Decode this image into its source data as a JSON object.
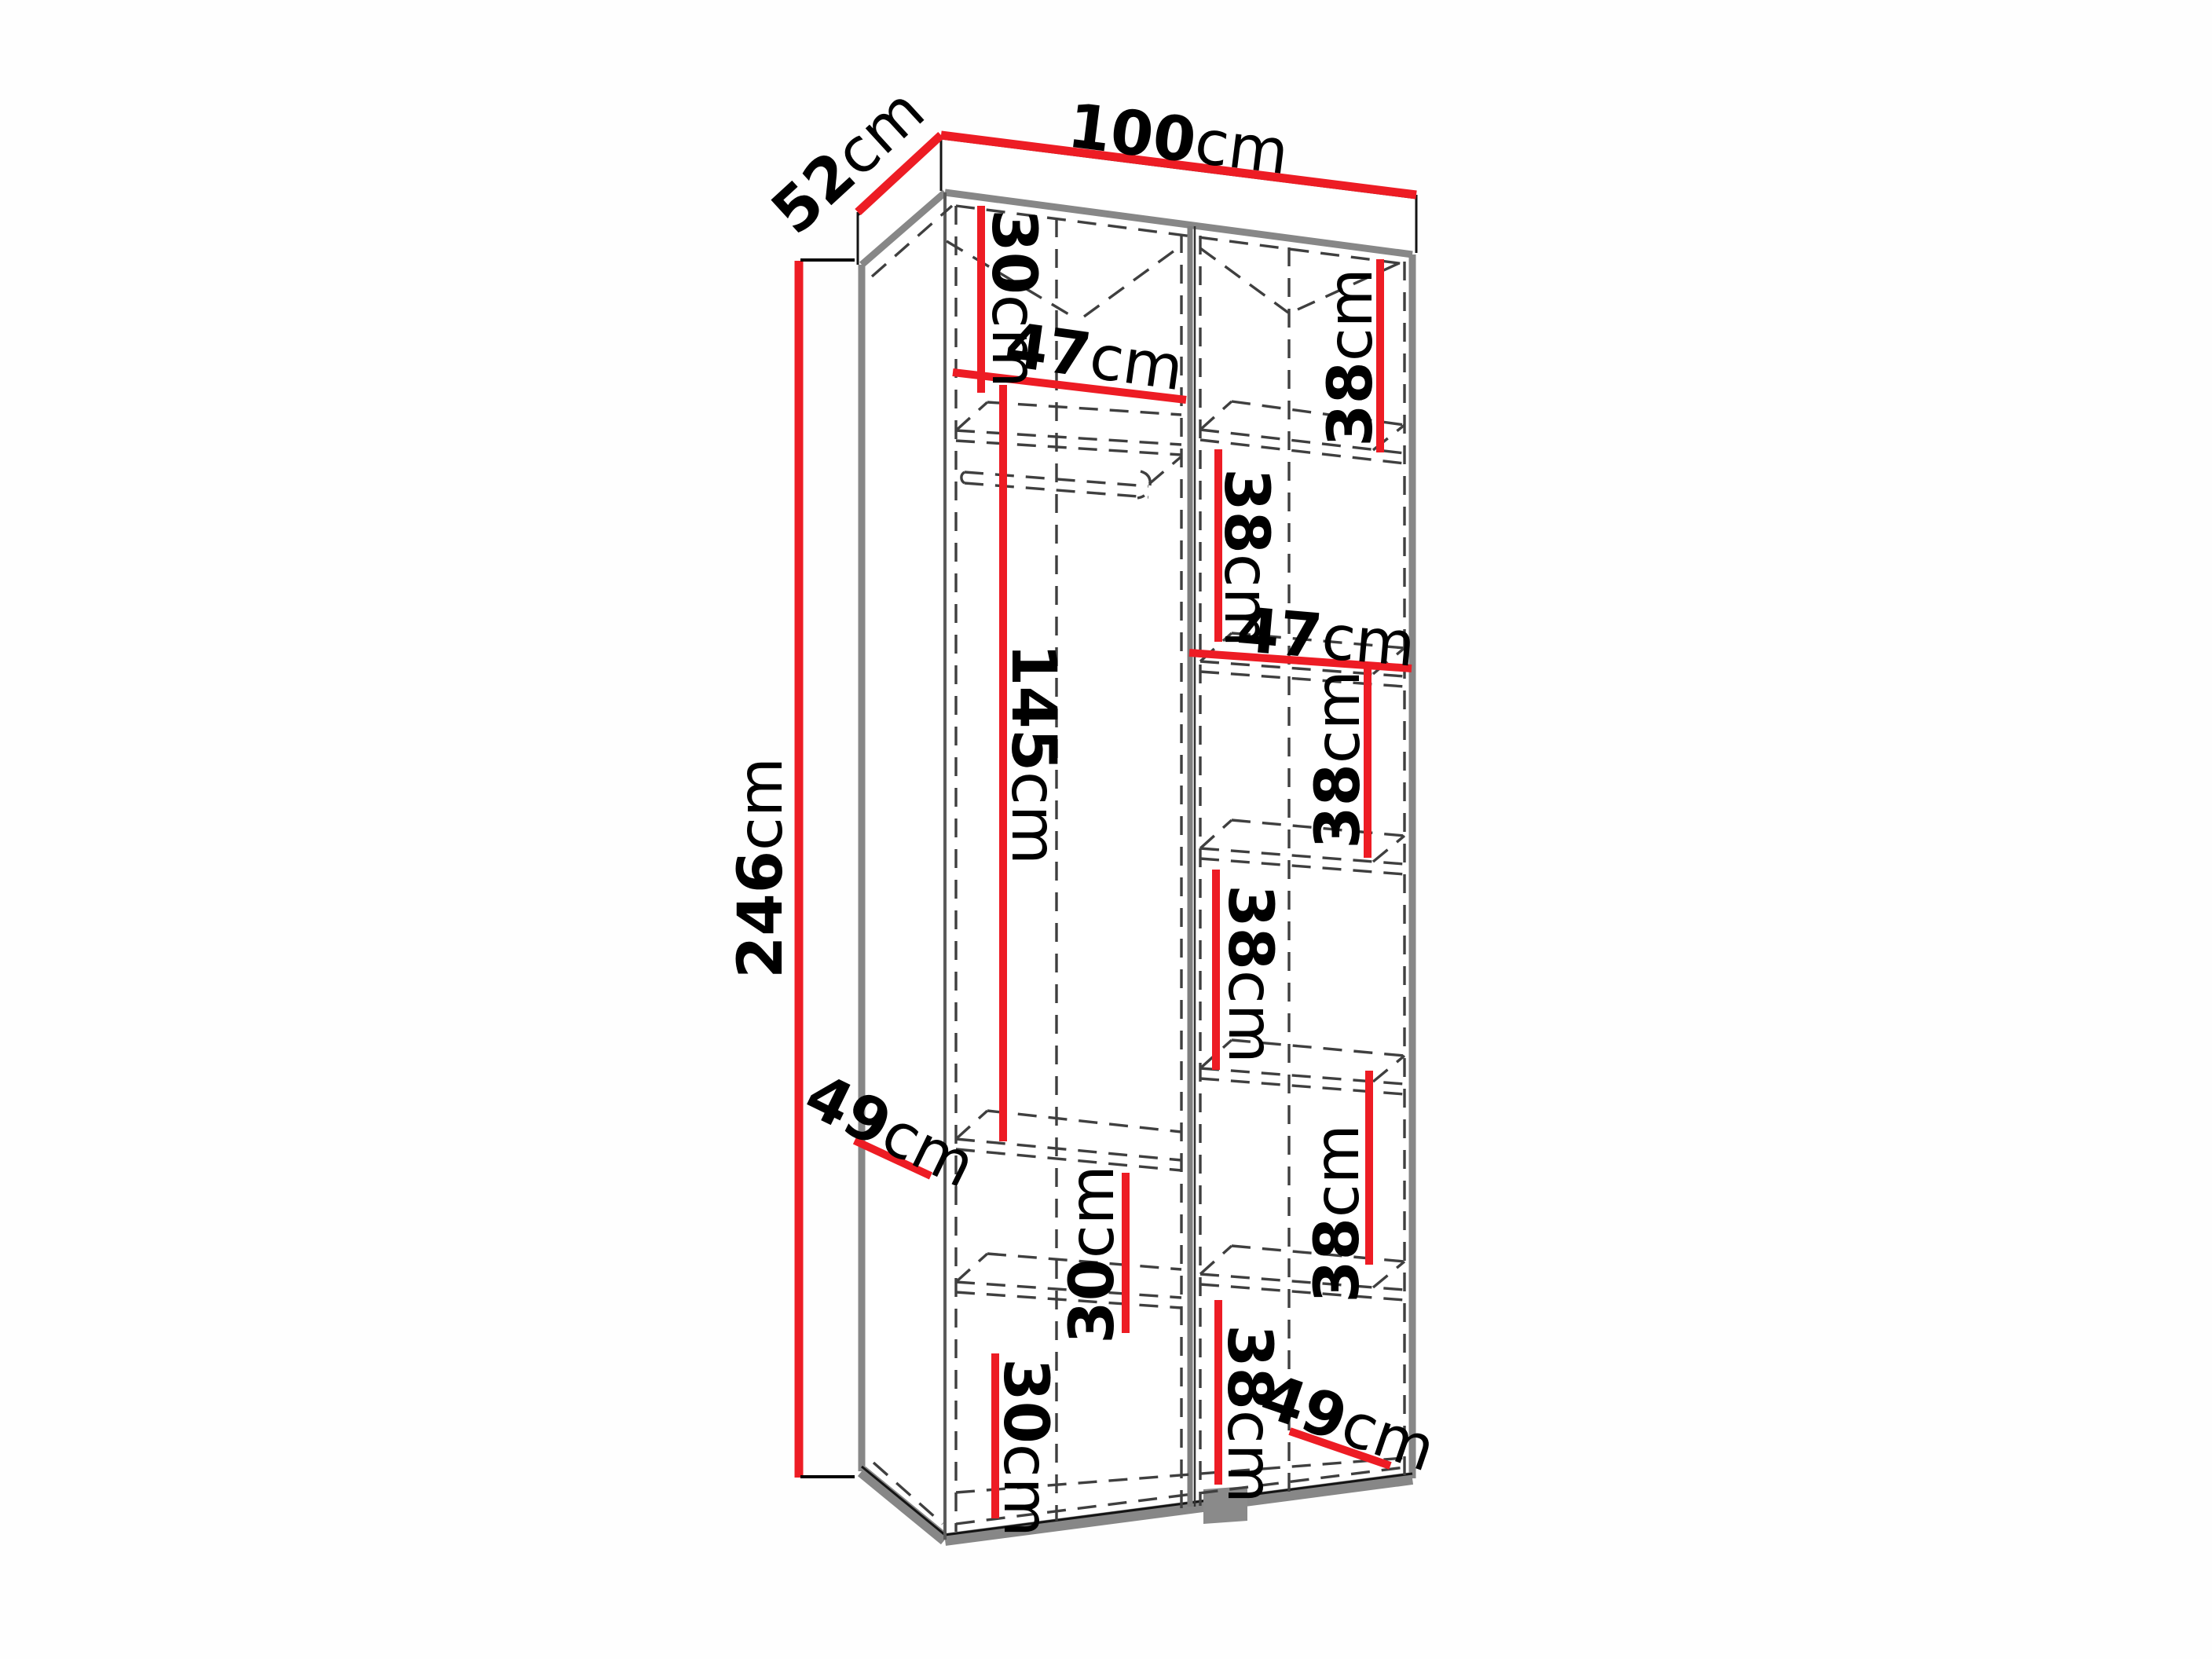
{
  "diagram": {
    "type": "wardrobe-dimension-diagram",
    "unit": "cm",
    "accent_color": "#ed1c24",
    "edge_color": "#878787"
  },
  "dims": {
    "width": {
      "num": "100",
      "unit": "cm"
    },
    "depth": {
      "num": "52",
      "unit": "cm"
    },
    "height": {
      "num": "246",
      "unit": "cm"
    },
    "top_section": {
      "num": "30",
      "unit": "cm"
    },
    "left_width": {
      "num": "47",
      "unit": "cm"
    },
    "hanging_height": {
      "num": "145",
      "unit": "cm"
    },
    "left_shelf_depth": {
      "num": "49",
      "unit": "cm"
    },
    "mid_section": {
      "num": "30",
      "unit": "cm"
    },
    "bottom_section": {
      "num": "30",
      "unit": "cm"
    },
    "right_s1": {
      "num": "38",
      "unit": "cm"
    },
    "right_s2": {
      "num": "38",
      "unit": "cm"
    },
    "right_width": {
      "num": "47",
      "unit": "cm"
    },
    "right_s3": {
      "num": "38",
      "unit": "cm"
    },
    "right_s4": {
      "num": "38",
      "unit": "cm"
    },
    "right_s5": {
      "num": "38",
      "unit": "cm"
    },
    "right_s6": {
      "num": "38",
      "unit": "cm"
    },
    "right_shelf_depth": {
      "num": "49",
      "unit": "cm"
    }
  }
}
